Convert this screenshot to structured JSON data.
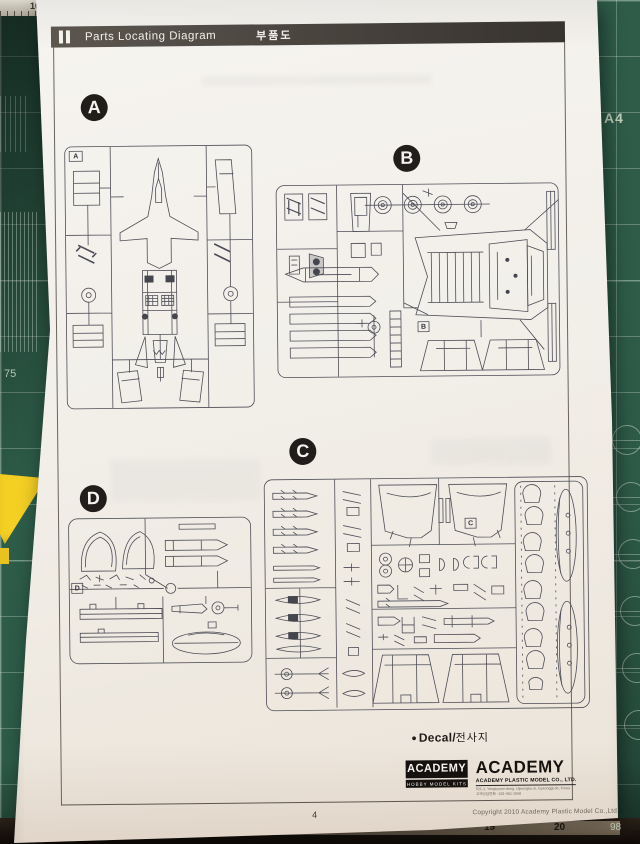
{
  "header": {
    "title": "Parts Locating Diagram",
    "title_kr": "부품도"
  },
  "sprues": [
    {
      "letter": "A",
      "tag": "A"
    },
    {
      "letter": "B",
      "tag": "B"
    },
    {
      "letter": "C",
      "tag": "C"
    },
    {
      "letter": "D",
      "tag": "D"
    }
  ],
  "decal": {
    "bullet": "●",
    "label_en": "Decal",
    "separator": "/",
    "label_kr": "전사지"
  },
  "logos": {
    "small": {
      "name": "ACADEMY",
      "subtitle": "HOBBY MODEL KITS"
    },
    "large": {
      "wordmark": "ACADEMY",
      "company": "ACADEMY PLASTIC MODEL CO., LTD.",
      "address_line1": "521-1, Yonghyeon-dong, Uijeongbu-si, Gyeonggi-do, Korea",
      "address_line2": "고객상담전화 : 031-901-1550"
    }
  },
  "footer": {
    "page_number": "4",
    "copyright": "Copyright 2010 Academy Plastic Model Co.,Ltd."
  },
  "mat": {
    "ruler_top_label": "10",
    "left_scale_label": "75",
    "size_label": "A4",
    "ruler_bottom": [
      "15",
      "16",
      "17",
      "18",
      "19",
      "20"
    ],
    "corner_label": "98"
  },
  "colors": {
    "mat_green": "#2e5c49",
    "header_bar": "#37332e",
    "paper": "#f2efe9",
    "line_art": "#4d4d57",
    "sticky_yellow": "#f4cf24"
  }
}
